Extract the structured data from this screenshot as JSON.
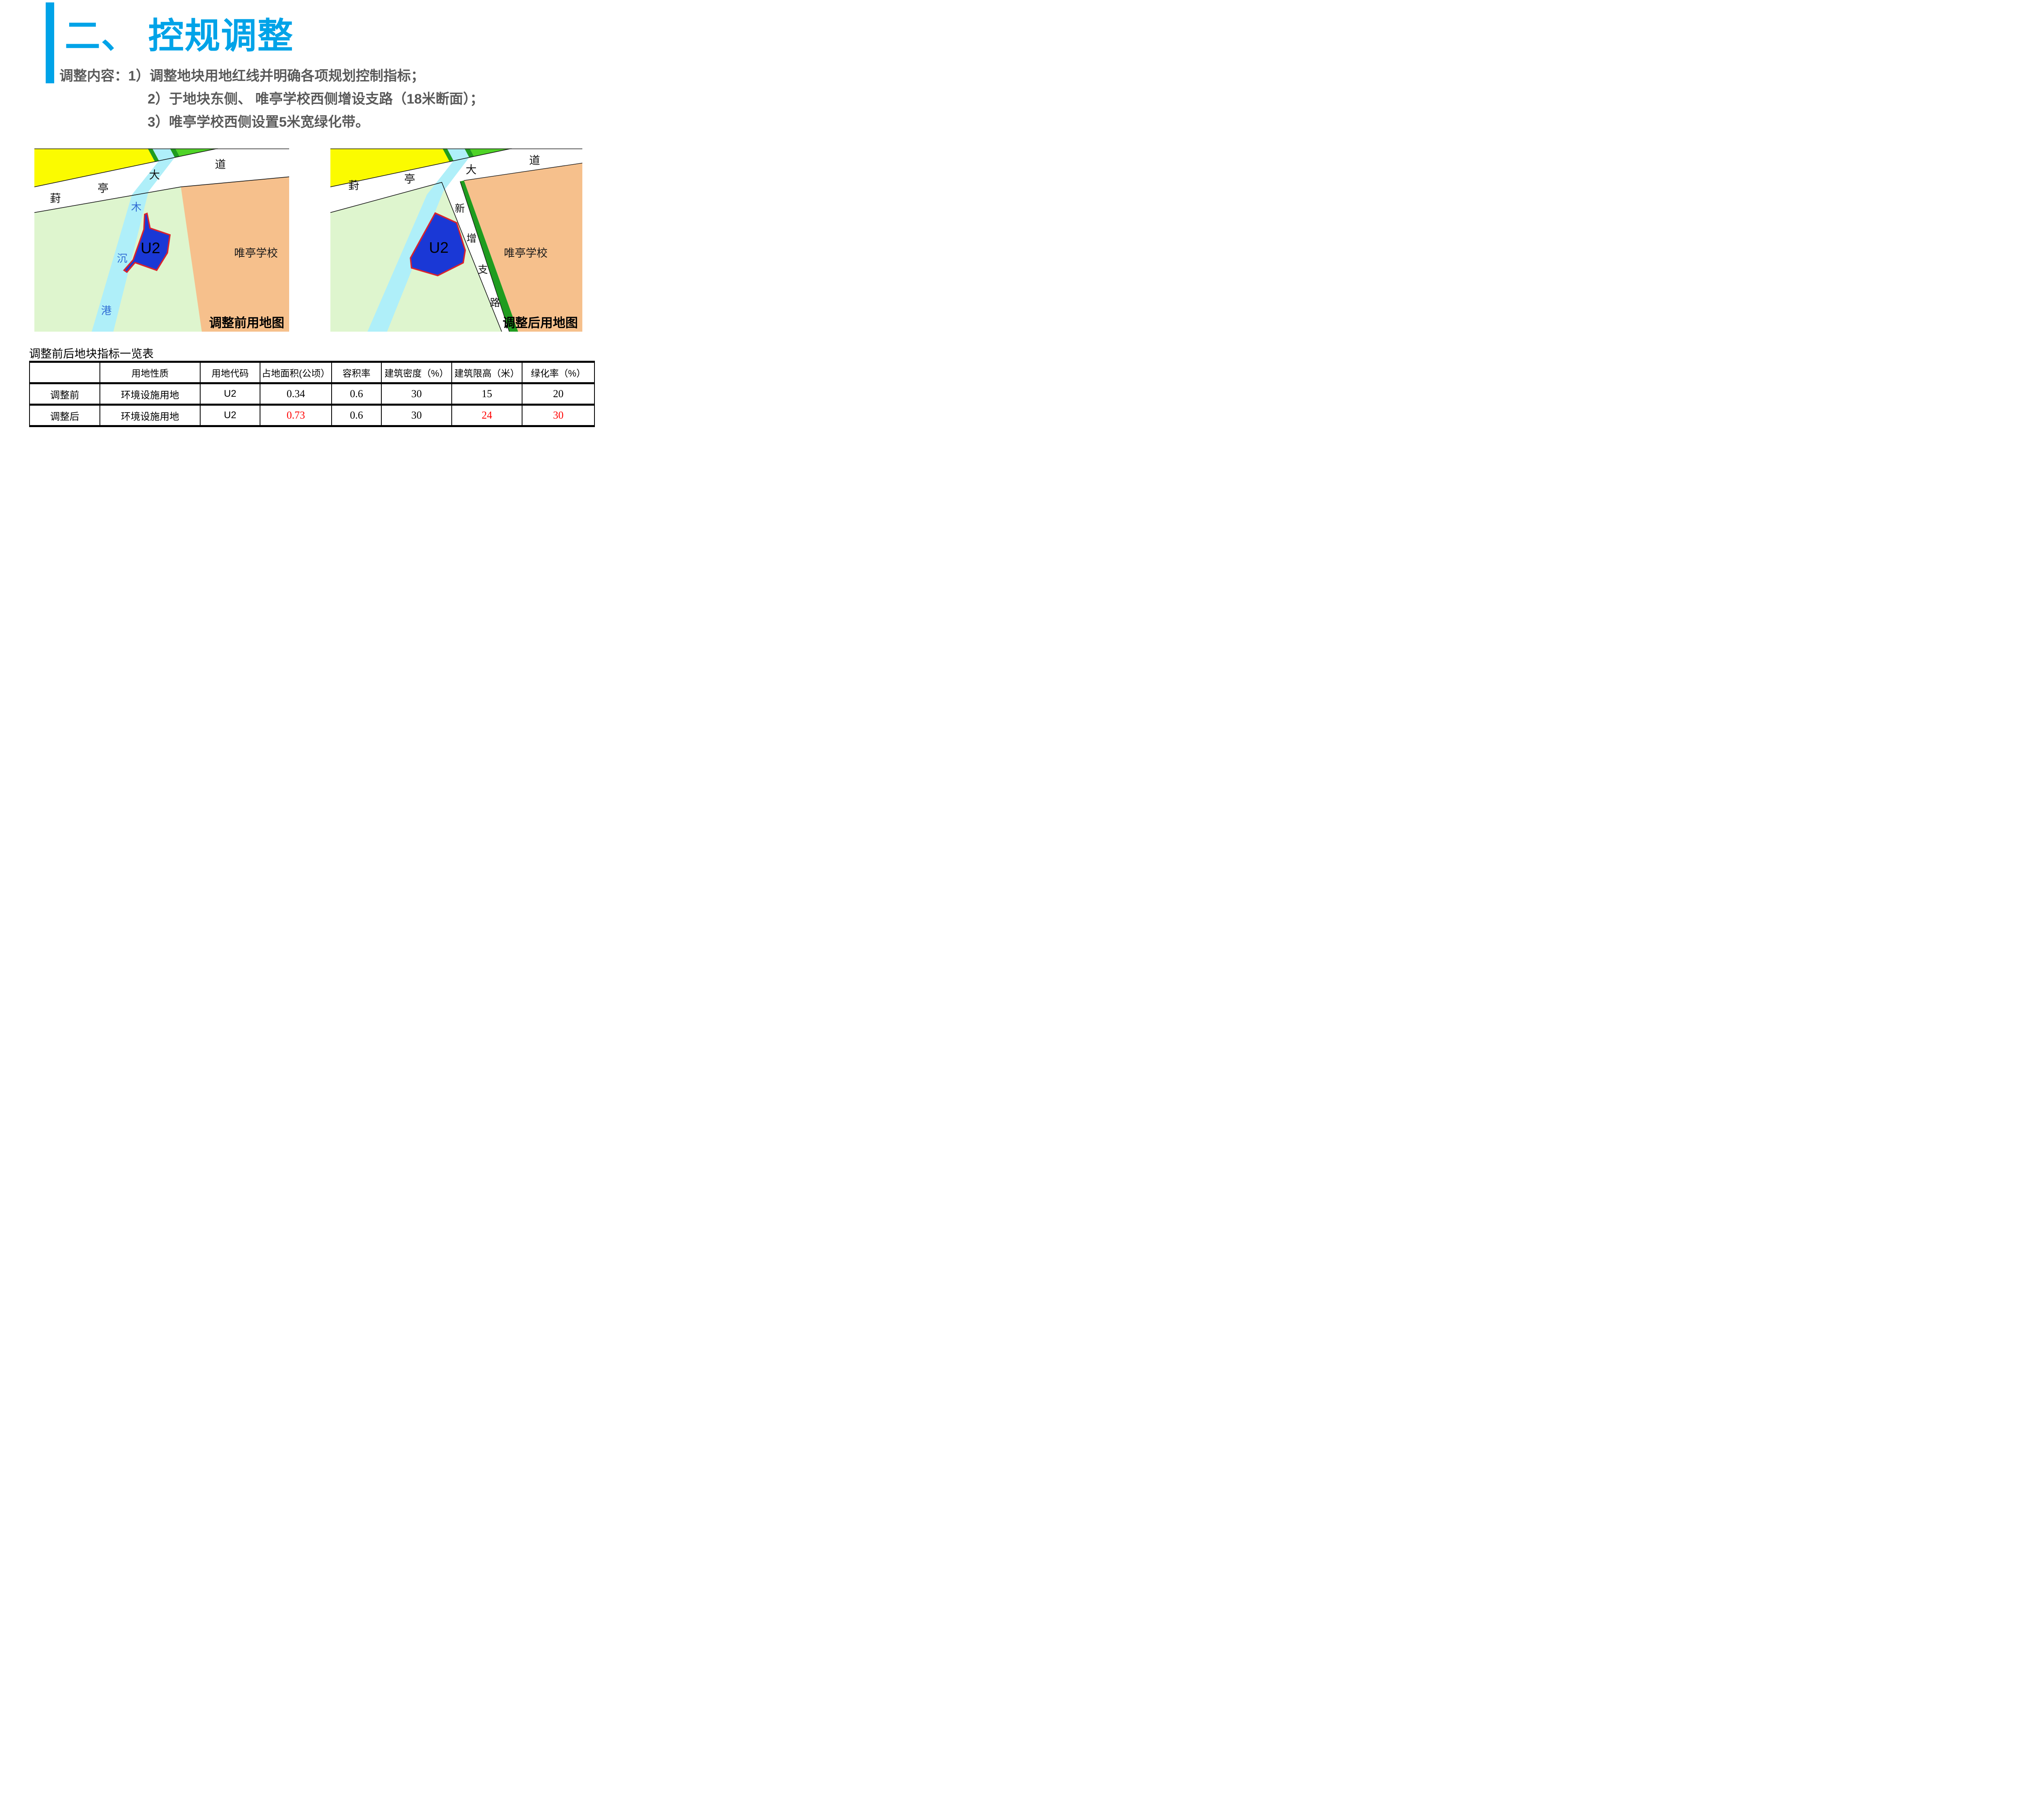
{
  "slide": {
    "title": "二、 控规调整",
    "intro_lines": [
      "调整内容：1）调整地块用地红线并明确各项规划控制指标；",
      "2）于地块东侧、 唯亭学校西侧增设支路（18米断面）；",
      "3）唯亭学校西侧设置5米宽绿化带。"
    ]
  },
  "maps": {
    "before": {
      "caption": "调整前用地图",
      "road_labels": [
        "葑",
        "亭",
        "大",
        "道"
      ],
      "canal_labels": [
        "木",
        "沉",
        "港"
      ],
      "parcel_label": "U2",
      "school_label": "唯亭学校"
    },
    "after": {
      "caption": "调整后用地图",
      "road_labels": [
        "葑",
        "亭",
        "大",
        "道"
      ],
      "new_road_labels": [
        "新",
        "增",
        "支",
        "路"
      ],
      "parcel_label": "U2",
      "school_label": "唯亭学校"
    }
  },
  "table": {
    "title": "调整前后地块指标一览表",
    "headers": [
      "",
      "用地性质",
      "用地代码",
      "占地面积(公顷）",
      "容积率",
      "建筑密度（%）",
      "建筑限高（米）",
      "绿化率（%）"
    ],
    "rows": [
      {
        "label": "调整前",
        "cells": [
          "环境设施用地",
          "U2",
          "0.34",
          "0.6",
          "30",
          "15",
          "20"
        ]
      },
      {
        "label": "调整后",
        "cells": [
          "环境设施用地",
          "U2",
          "0.73",
          "0.6",
          "30",
          "24",
          "30"
        ]
      }
    ]
  },
  "colors": {
    "accent_cyan": "#00A3E8",
    "body_text_gray": "#595959",
    "highlight_red": "#FF0000",
    "parcel_blue": "#1A38D6",
    "parcel_border_red": "#D9232E",
    "canal_cyan": "#AFEFF9",
    "school_orange": "#F6C08C",
    "field_pale_green": "#DEF5CE",
    "bright_green": "#4FD327",
    "dark_green": "#1F9C1F",
    "land_yellow": "#FBFB00",
    "canal_label_blue": "#2E6BD4"
  }
}
